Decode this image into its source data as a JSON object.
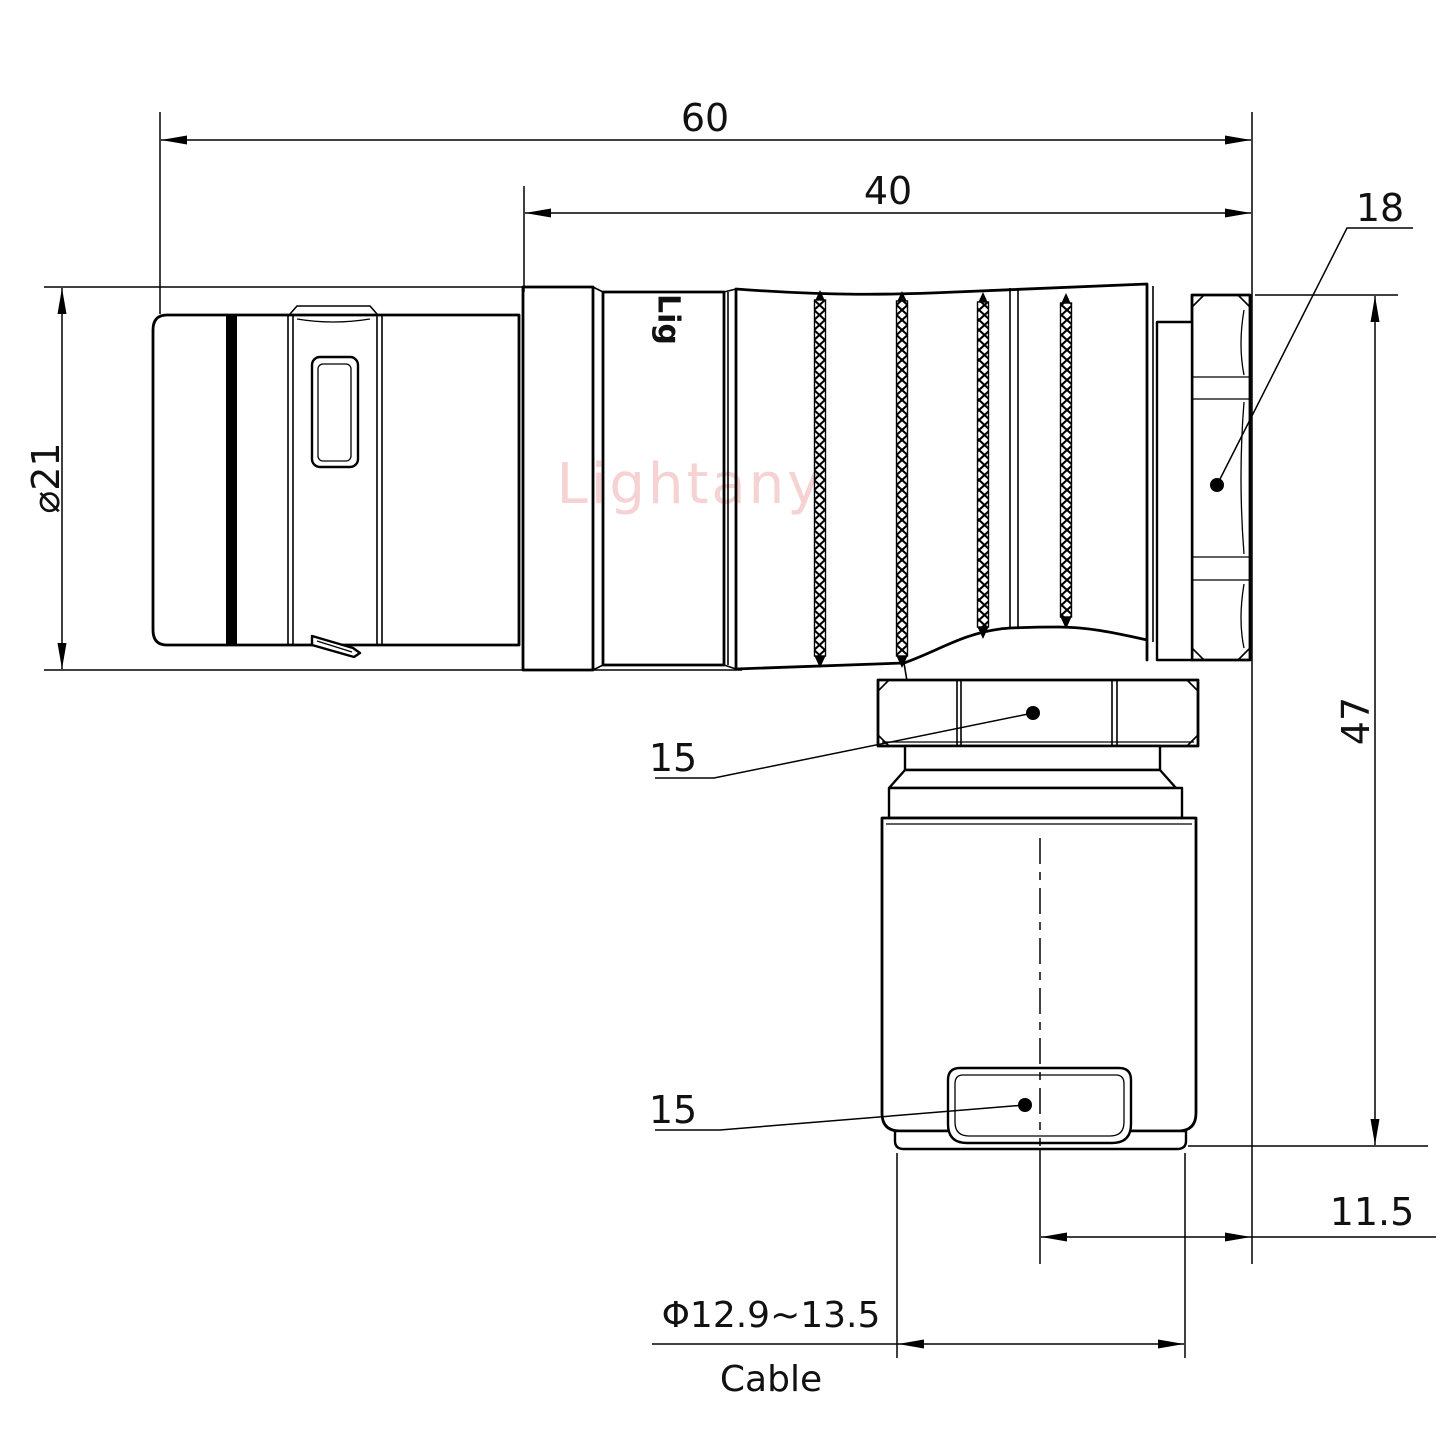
{
  "watermark": {
    "text": "Lightany"
  },
  "marking": {
    "text": "Lig"
  },
  "dims": {
    "overall_length": "60",
    "front_length": "40",
    "coupling_nut_af": "18",
    "shell_diameter": "⌀21",
    "overall_height": "47",
    "gland_nut_af": "15",
    "clamp_af": "15",
    "axis_to_face": "11.5",
    "cable_diameter_range": "Φ12.9~13.5",
    "cable_word": "Cable"
  },
  "colors": {
    "line": "#000000",
    "watermark_pink": "#f6d2d2",
    "background": "#ffffff"
  }
}
